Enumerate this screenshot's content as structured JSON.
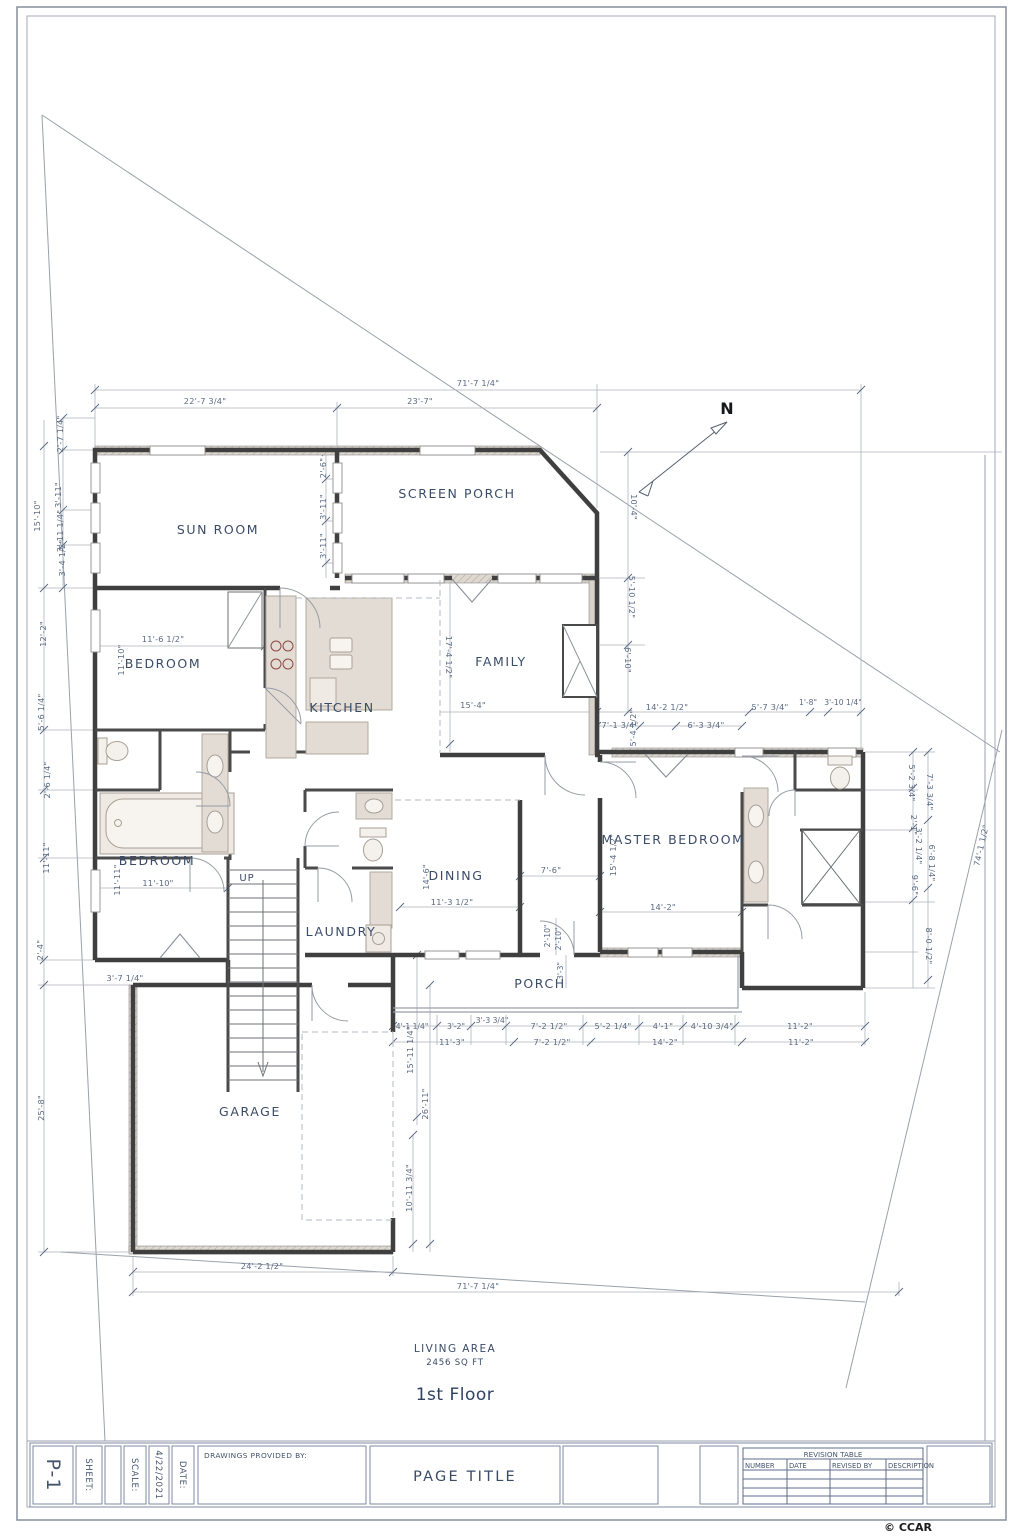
{
  "sheet": {
    "north_label": "N",
    "living_area_title": "LIVING AREA",
    "living_area_value": "2456 SQ FT",
    "floor_label": "1st Floor",
    "copyright": "© CCAR"
  },
  "title_block": {
    "sheet_number": "P-1",
    "sheet_label": "SHEET:",
    "scale_label": "SCALE:",
    "date_value": "4/22/2021",
    "date_label": "DATE:",
    "drawings_by_label": "DRAWINGS PROVIDED BY:",
    "page_title": "PAGE TITLE"
  },
  "revision_table": {
    "title": "REVISION TABLE",
    "columns": [
      "NUMBER",
      "DATE",
      "REVISED BY",
      "DESCRIPTION"
    ]
  },
  "rooms": {
    "sun_room": "SUN ROOM",
    "screen_porch": "SCREEN PORCH",
    "bedroom1": "BEDROOM",
    "kitchen": "KITCHEN",
    "family": "FAMILY",
    "bedroom2": "BEDROOM",
    "laundry": "LAUNDRY",
    "dining": "DINING",
    "master_bedroom": "MASTER BEDROOM",
    "porch": "PORCH",
    "garage": "GARAGE",
    "stairs_up": "UP"
  },
  "dims": {
    "top_total": "71'-7 1/4\"",
    "top_left": "22'-7 3/4\"",
    "top_right": "23'-7\"",
    "l_2_7_14": "2'-7 1/4\"",
    "l_3_11": "3'-11\"",
    "l_15_10": "15'-10\"",
    "l_3_11_14": "3'-11 1/4\"",
    "l_3_4_12": "3'-4 1/2\"",
    "l_12_2": "12'-2\"",
    "l_5_6_14": "5'-6 1/4\"",
    "l_2_6_14": "2'-6 1/4\"",
    "l_11_11": "11'-11\"",
    "l_2_4": "2'-4\"",
    "l_25_8": "25'-8\"",
    "l_3_7_14": "3'-7 1/4\"",
    "sp_2_6": "2'-6\"",
    "sp_3_11a": "3'-11\"",
    "sp_3_11b": "3'-11\"",
    "r_10_4": "10'-4\"",
    "r_5_10_12": "5'-10 1/2\"",
    "r_6_10": "6'-10\"",
    "fam_17_4_12": "17'-4 1/2\"",
    "fam_15_4": "15'-4\"",
    "bed1_11_6_12": "11'-6 1/2\"",
    "bed1_11_10": "11'-10\"",
    "bed2_11_10": "11'-10\"",
    "bed2_11_11": "11'-11\"",
    "mb_14_2_12": "14'-2 1/2\"",
    "mb_5_7_34": "5'-7 3/4\"",
    "mb_1_8": "1'-8\"",
    "mb_3_10_14": "3'-10 1/4\"",
    "mb_7_1_34": "7'-1 3/4\"",
    "mb_5_4_12": "5'-4 1/2\"",
    "mb_6_3_34": "6'-3 3/4\"",
    "mb_15_4_12": "15'-4 1/2\"",
    "mb_14_2": "14'-2\"",
    "hall_7_6": "7'-6\"",
    "din_14_6": "14'-6\"",
    "din_11_3_12": "11'-3 1/2\"",
    "por_2_10a": "2'-10\"",
    "por_2_10b": "2'-10\"",
    "por_3_3": "3'-3\"",
    "rr_5_2_34": "5'-2 3/4\"",
    "rr_7_3_34": "7'-3 3/4\"",
    "rr_2_1": "2'-1\"",
    "rr_3_2_14": "3'-2 1/4\"",
    "rr_6_8_14": "6'-8 1/4\"",
    "rr_9_6": "9'-6\"",
    "rr_8_0_12": "8'-0 1/2\"",
    "rr_74_1_12": "74'-1 1/2\"",
    "b1_4_1_14": "4'-1 1/4\"",
    "b1_3_2": "3'-2\"",
    "b1_3_3_34": "3'-3 3/4\"",
    "b1_7_2_12": "7'-2 1/2\"",
    "b1_5_2_14": "5'-2 1/4\"",
    "b1_4_1": "4'-1\"",
    "b1_4_10_34": "4'-10 3/4\"",
    "b1_11_2": "11'-2\"",
    "b2_11_3": "11'-3\"",
    "b2_7_2_12": "7'-2 1/2\"",
    "b2_14_2": "14'-2\"",
    "b2_11_2": "11'-2\"",
    "g_15_11_14": "15'-11 1/4\"",
    "g_26_11": "26'-11\"",
    "g_10_11_34": "10'-11 3/4\"",
    "g_24_2_12": "24'-2 1/2\"",
    "bot_total": "71'-7 1/4\""
  }
}
